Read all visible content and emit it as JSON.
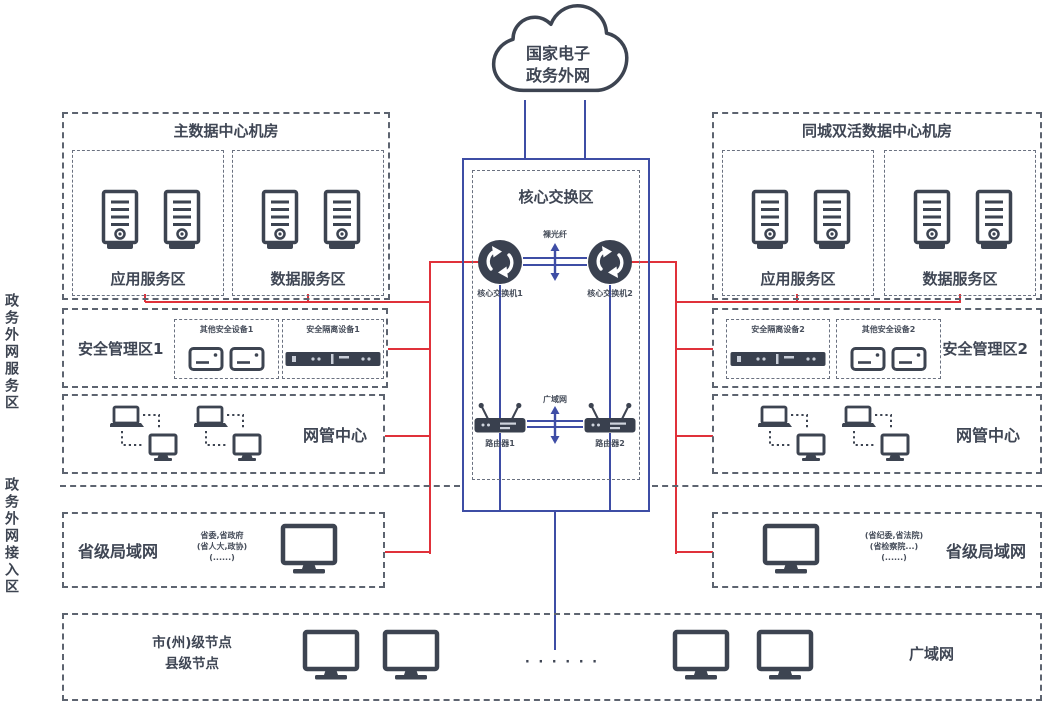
{
  "cloud": {
    "line1": "国家电子",
    "line2": "政务外网"
  },
  "side_labels": {
    "upper": "政务外网服务区",
    "lower": "政务外网接入区"
  },
  "main_dc": {
    "title": "主数据中心机房",
    "app_zone": "应用服务区",
    "data_zone": "数据服务区"
  },
  "twin_dc": {
    "title": "同城双活数据中心机房",
    "app_zone": "应用服务区",
    "data_zone": "数据服务区"
  },
  "core": {
    "title": "核心交换区",
    "fiber_label": "裸光纤",
    "switch1": "核心交换机1",
    "switch2": "核心交换机2",
    "wan_link_label": "广域网",
    "router1": "路由器1",
    "router2": "路由器2"
  },
  "security_left": {
    "title": "安全管理区1",
    "devices_label": "其他安全设备1",
    "appliance_label": "安全隔离设备1"
  },
  "security_right": {
    "title": "安全管理区2",
    "appliance_label": "安全隔离设备2",
    "devices_label": "其他安全设备2"
  },
  "nms_left": {
    "title": "网管中心"
  },
  "nms_right": {
    "title": "网管中心"
  },
  "lan_left": {
    "title": "省级局域网",
    "notes": [
      "省委,省政府",
      "(省人大,政协)",
      "(......)"
    ]
  },
  "lan_right": {
    "title": "省级局域网",
    "notes": [
      "(省纪委,省法院)",
      "(省检察院...)",
      "(......)"
    ]
  },
  "wan_band": {
    "node_line1": "市(州)级节点",
    "node_line2": "县级节点",
    "dots": "· · · · · ·",
    "wan_title": "广域网"
  },
  "colors": {
    "red_line": "#e0313a",
    "blue_line": "#3e4da5",
    "ink": "#3d4451"
  }
}
